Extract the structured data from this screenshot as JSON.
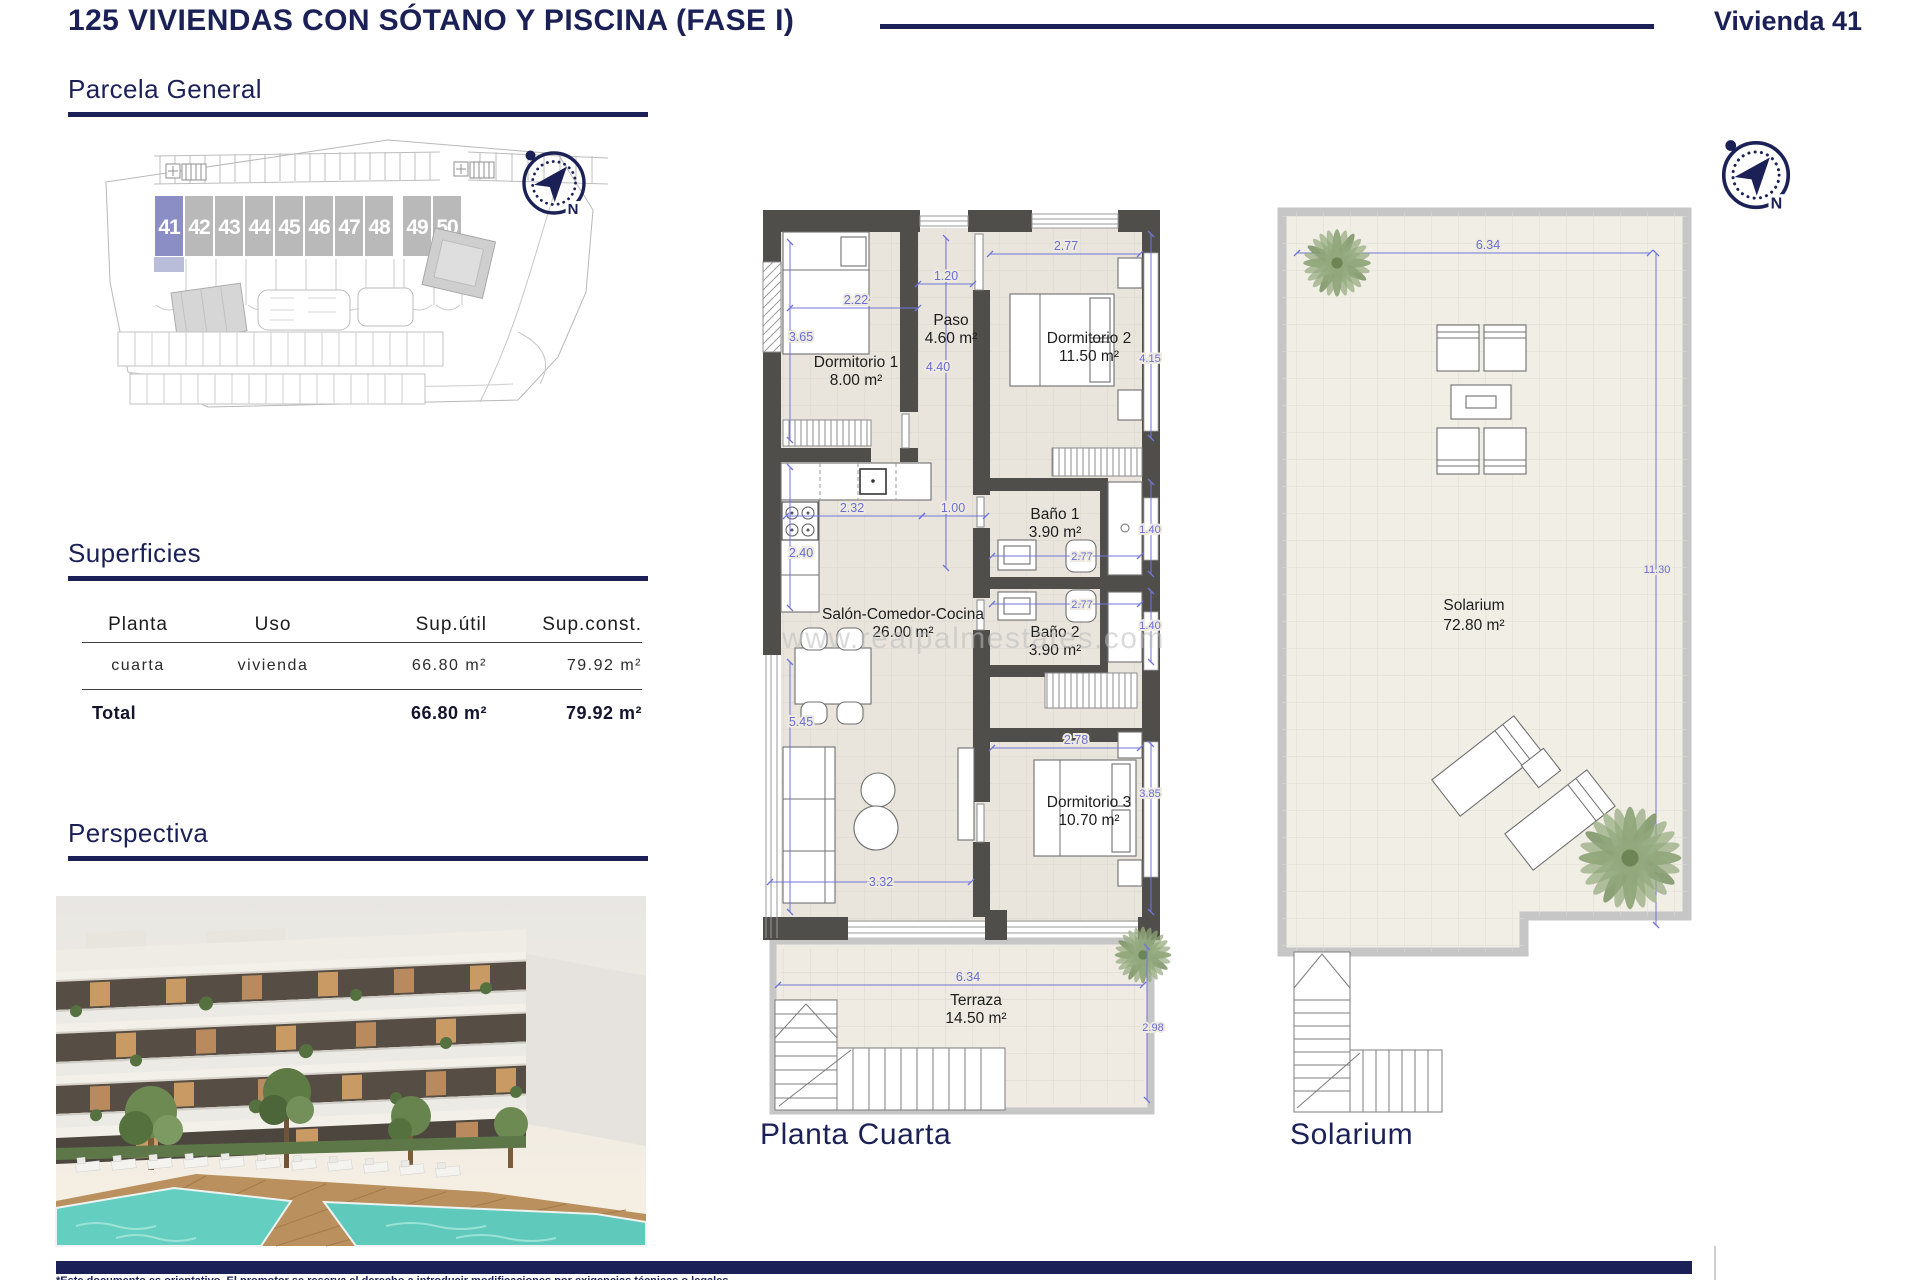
{
  "header": {
    "title": "125 VIVIENDAS CON SÓTANO Y PISCINA (FASE I)",
    "vivienda": "Vivienda 41"
  },
  "sections": {
    "parcela": "Parcela General",
    "superficies": "Superficies",
    "perspectiva": "Perspectiva"
  },
  "site": {
    "units": [
      "41",
      "42",
      "43",
      "44",
      "45",
      "46",
      "47",
      "48",
      "49",
      "50"
    ],
    "highlighted_unit": "41"
  },
  "superficies_table": {
    "headers": [
      "Planta",
      "Uso",
      "Sup.útil",
      "Sup.const."
    ],
    "row": {
      "planta": "cuarta",
      "uso": "vivienda",
      "util": "66.80 m²",
      "const": "79.92 m²"
    },
    "total": {
      "label": "Total",
      "util": "66.80 m²",
      "const": "79.92 m²"
    }
  },
  "floorplan": {
    "caption": "Planta Cuarta",
    "rooms": {
      "dorm1": {
        "name": "Dormitorio 1",
        "area": "8.00 m²"
      },
      "paso": {
        "name": "Paso",
        "area": "4.60 m²"
      },
      "dorm2": {
        "name": "Dormitorio 2",
        "area": "11.50 m²"
      },
      "bano1": {
        "name": "Baño 1",
        "area": "3.90 m²"
      },
      "bano2": {
        "name": "Baño 2",
        "area": "3.90 m²"
      },
      "salon": {
        "name": "Salón-Comedor-Cocina",
        "area": "26.00 m²"
      },
      "dorm3": {
        "name": "Dormitorio 3",
        "area": "10.70 m²"
      },
      "terraza": {
        "name": "Terraza",
        "area": "14.50 m²"
      }
    },
    "dims": {
      "left_v": "3.65",
      "dorm1_w": "2.22",
      "paso_w": "1.20",
      "paso_h": "4.40",
      "dorm2_w": "2.77",
      "dorm2_h": "4.15",
      "kitchen_w": "2.32",
      "hall_w": "1.00",
      "kitchen_h": "2.40",
      "bano1_h": "1.40",
      "bano1_w": "2.77",
      "bano2_w": "2.77",
      "bano2_h": "1.40",
      "salon_h": "5.45",
      "dorm3_w": "2.78",
      "dorm3_h": "3.85",
      "salon_w": "3.32",
      "terraza_w": "6.34",
      "terraza_h": "2.98"
    }
  },
  "solarium": {
    "caption": "Solarium",
    "room": {
      "name": "Solarium",
      "area": "72.80 m²"
    },
    "dims": {
      "width": "6.34",
      "height": "11.30"
    }
  },
  "compass": {
    "north": "N"
  },
  "watermark": "www.realpalmestates.com",
  "footer": {
    "disclaimer": "*Este documento es orientativo. El promotor se reserva el derecho a introducir modificaciones por exigencias técnicas o legales."
  },
  "colors": {
    "navy": "#1b2156",
    "dim_blue": "#6c71d6",
    "wall": "#4f4e4b",
    "floor": "#e9e5dc",
    "highlight": "#8b8ec4",
    "pool": "#5fcabb"
  }
}
